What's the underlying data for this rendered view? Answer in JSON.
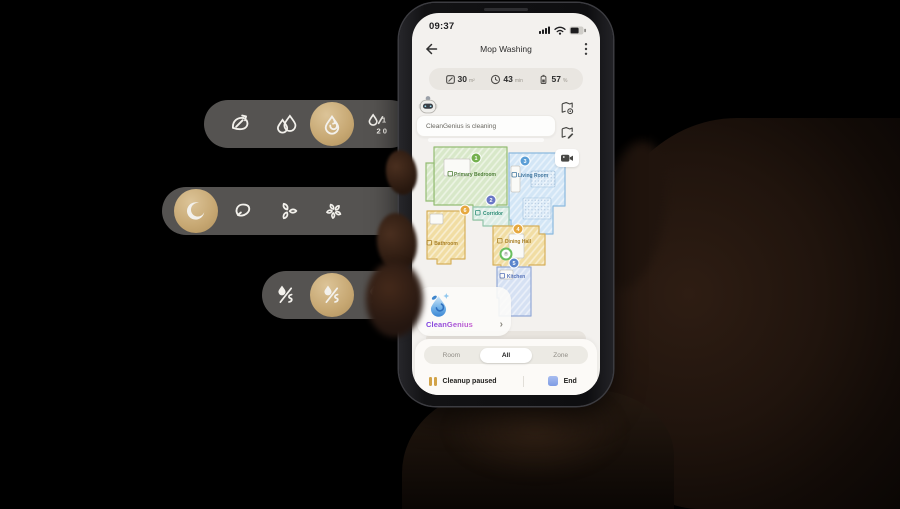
{
  "phone": {
    "status_bar": {
      "time": "09:37",
      "icons": [
        "signal-icon",
        "wifi-icon",
        "battery-status-icon"
      ]
    },
    "header": {
      "title": "Mop Washing",
      "back_icon": "back-arrow-icon",
      "menu_icon": "kebab-menu-icon"
    },
    "stats": [
      {
        "icon": "area-icon",
        "value": "30",
        "unit": "m²"
      },
      {
        "icon": "clock-icon",
        "value": "43",
        "unit": "min"
      },
      {
        "icon": "battery-icon",
        "value": "57",
        "unit": "%"
      }
    ],
    "assistant": {
      "avatar": "robot-avatar",
      "message": "CleanGenius is cleaning"
    },
    "map_tools": [
      {
        "icon": "map-settings-icon"
      },
      {
        "icon": "map-edit-icon"
      },
      {
        "icon": "camera-icon"
      }
    ],
    "map": {
      "rooms": [
        {
          "name": "Primary Bedroom",
          "number": "1",
          "fill": "#d8e8c9",
          "stroke": "#94bd74",
          "label_color": "#4f7f38",
          "badge_color": "#74b14e"
        },
        {
          "name": "Living Room",
          "number": "3",
          "fill": "#d3e6f6",
          "stroke": "#8bb9de",
          "label_color": "#42779f",
          "badge_color": "#5b9ed6"
        },
        {
          "name": "Corridor",
          "number": "2",
          "fill": "#dcede5",
          "stroke": "#93c5ab",
          "label_color": "#2f8d78",
          "badge_color": "#6a77c6"
        },
        {
          "name": "Bathroom",
          "number": "6",
          "fill": "#f1dda3",
          "stroke": "#d6b05c",
          "label_color": "#a97f24",
          "badge_color": "#e6a83f"
        },
        {
          "name": "Dining Hall",
          "number": "4",
          "fill": "#f1dda3",
          "stroke": "#d6b05c",
          "label_color": "#a97f24",
          "badge_color": "#e6a83f"
        },
        {
          "name": "Kitchen",
          "number": "5",
          "fill": "#d6e1f3",
          "stroke": "#93a9d6",
          "label_color": "#5672b8",
          "badge_color": "#5b85cc"
        }
      ],
      "robot_marker": "robot-position"
    },
    "cleangenius": {
      "icon": "water-drop-icon",
      "label": "CleanGenius",
      "chevron": "›"
    },
    "tabs": {
      "items": [
        "Room",
        "All",
        "Zone"
      ],
      "selected": "All"
    },
    "controls": {
      "pause_icon": "pause-icon",
      "pause_label": "Cleanup paused",
      "end_icon": "end-square",
      "end_label": "End"
    }
  },
  "overlay_pills": [
    {
      "name": "mop-wash-options",
      "items": [
        {
          "icon": "fan-swirl-icon",
          "selected": false
        },
        {
          "icon": "double-drop-icon",
          "selected": false
        },
        {
          "icon": "drop-swirl-icon",
          "selected": true
        },
        {
          "icon": "drop-120-icon",
          "selected": false
        }
      ]
    },
    {
      "name": "suction-options",
      "items": [
        {
          "icon": "moon-icon",
          "selected": true
        },
        {
          "icon": "swirl-soft-icon",
          "selected": false
        },
        {
          "icon": "swirl-medium-icon",
          "selected": false
        },
        {
          "icon": "swirl-strong-icon",
          "selected": false
        }
      ]
    },
    {
      "name": "water-flow-options",
      "items": [
        {
          "icon": "water-flow-low-icon",
          "selected": false
        },
        {
          "icon": "water-flow-medium-icon",
          "selected": true
        },
        {
          "icon": "water-flow-high-icon",
          "selected": false
        }
      ]
    }
  ],
  "colors": {
    "selected_gold": "#c7a873",
    "pill_bg": "#565452",
    "pause_gold": "#d2a348",
    "end_blue": "#8ca6e6",
    "cleangenius_gradient": [
      "#7a3fe0",
      "#c65ecf"
    ]
  }
}
